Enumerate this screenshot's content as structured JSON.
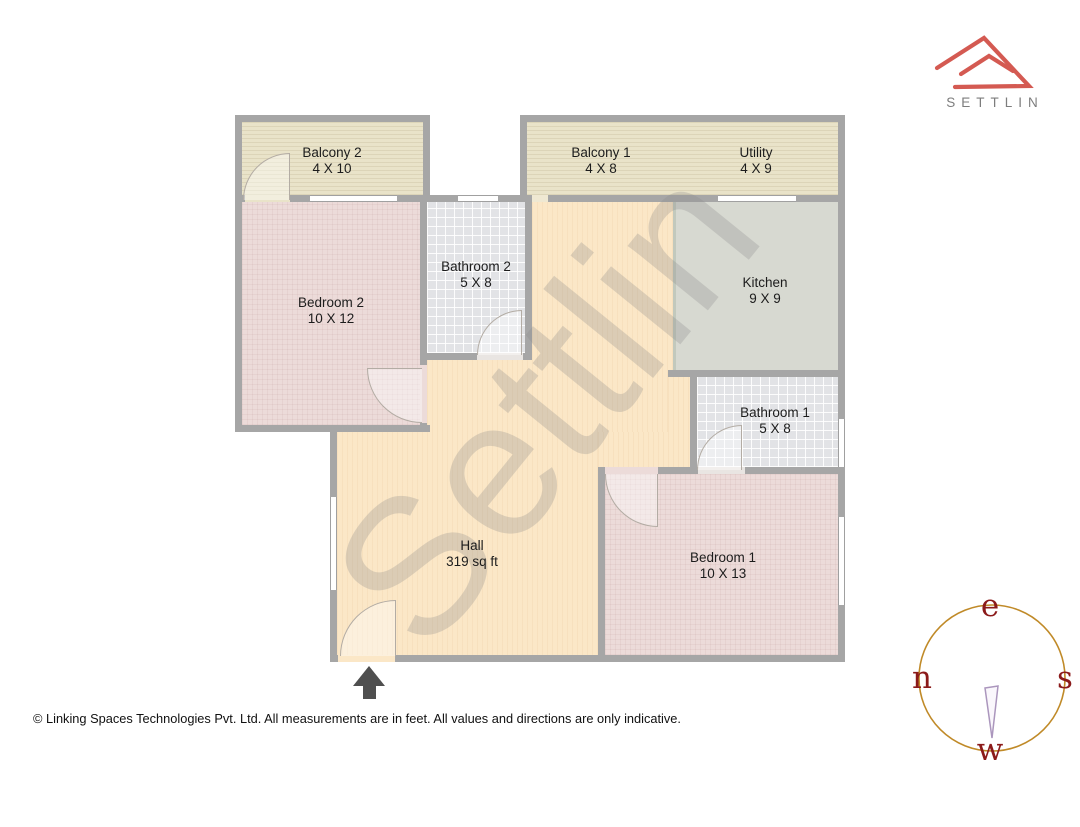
{
  "logo": {
    "brand": "SETTLIN"
  },
  "watermark": {
    "text": "Settlin"
  },
  "rooms": {
    "balcony2": {
      "name": "Balcony 2",
      "dims": "4 X 10"
    },
    "balcony1": {
      "name": "Balcony 1",
      "dims": "4 X 8"
    },
    "utility": {
      "name": "Utility",
      "dims": "4 X 9"
    },
    "bedroom2": {
      "name": "Bedroom 2",
      "dims": "10 X 12"
    },
    "bathroom2": {
      "name": "Bathroom 2",
      "dims": "5 X 8"
    },
    "kitchen": {
      "name": "Kitchen",
      "dims": "9 X 9"
    },
    "bathroom1": {
      "name": "Bathroom 1",
      "dims": "5 X 8"
    },
    "bedroom1": {
      "name": "Bedroom 1",
      "dims": "10 X 13"
    },
    "hall": {
      "name": "Hall",
      "dims": "319 sq ft"
    }
  },
  "compass": {
    "top": "e",
    "right": "s",
    "bottom": "w",
    "left": "n"
  },
  "footer": {
    "text": "© Linking Spaces Technologies Pvt. Ltd. All measurements are in feet. All values and directions are only indicative."
  },
  "colors": {
    "brand_red": "#d45a52",
    "brand_gray": "#7d7d7d",
    "wall_gray": "#a6a6a6",
    "hall_floor": "#fbe7c7",
    "bedroom_floor": "#ecdbd9",
    "balcony_floor": "#e9e3c9",
    "bathroom_floor": "#e2e3e6",
    "kitchen_floor": "#d7d9d1",
    "compass_ring": "#c08a28",
    "compass_letters": "#8b1a1a",
    "compass_needle": "#ab96bd"
  }
}
